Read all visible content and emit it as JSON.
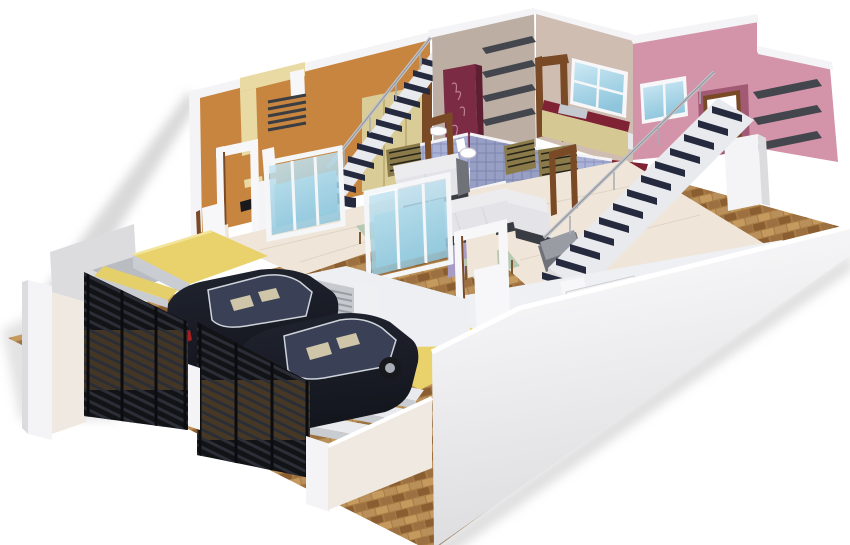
{
  "image": {
    "kind": "3d-architectural-cutaway-render",
    "subject": "duplex-house-floor-plan",
    "visible_text": "none"
  },
  "colors": {
    "bg": "#ffffff",
    "shadow": "#c2c2c2",
    "brick_base": "#a87a44",
    "brick_dark": "#8a5e31",
    "brick_mid": "#9c7040",
    "brick_light": "#c59a5e",
    "brick_soft": "#b9905a",
    "wall_white": "#f4f4f6",
    "wall_white_shade": "#dcdcdf",
    "wall_cream": "#efe9e1",
    "orange_wall": "#c8853f",
    "cream_arch": "#e9d9a3",
    "beige_wall": "#cfbdb1",
    "partition_wall": "#bdaea4",
    "pink_wall": "#d394a9",
    "pink_wall_dark": "#a25a74",
    "maroon_wall": "#8d4862",
    "lavender_wall": "#a89bc4",
    "tile_blue": "#a9b1d6",
    "tile_line": "#8f97c2",
    "glass_blue_light": "#cde9f4",
    "glass_blue_deep": "#8fc6dd",
    "glass_teal": "#9fd2da",
    "frame_white": "#f7f7f9",
    "door_brown": "#7a4a26",
    "wardrobe_cream": "#d9cc96",
    "cabinet_maroon": "#7c2b45",
    "shelf_dark": "#43464c",
    "stair_tread": "#262a3e",
    "stair_stringer": "#e8eaee",
    "handrail_silver": "#c0c3c9",
    "sofa_white": "#ececef",
    "sofa_dark": "#3a3c44",
    "sofa_gray": "#70727a",
    "table_green": "#b7c8b2",
    "counter_maroon": "#7e2234",
    "cabinet_kitchen": "#d6c893",
    "steel": "#c4c9cf",
    "stove_black": "#1d1f24",
    "yellow_porch": "#e9d26b",
    "yellow_step": "#e5cf6a",
    "concrete": "#c9ccd1",
    "gate_black": "#121317",
    "gate_slat": "#2b2e36",
    "gate_tan": "#96713a",
    "car_body": "#20242f",
    "car_body_dark": "#14161e",
    "car_glass": "#3a4156",
    "car_trim": "#cfd3da",
    "car_seat": "#cfc5a8",
    "wheel_dark": "#17181c",
    "wheel_silver": "#a9adb5",
    "taillight_red": "#a81f1f",
    "floor_marble": "#efe6d9",
    "louver_brown": "#8a7a4a",
    "seam_gray": "#d9d9de"
  },
  "scene": {
    "objects": [
      "brick-paved-yard",
      "white-compound-wall",
      "black-slatted-gate-left",
      "black-slatted-gate-right",
      "sedan-car-rear",
      "sedan-car-front",
      "yellow-porch-left-unit",
      "yellow-porch-right-unit",
      "orange-feature-wall",
      "cream-arch-decor",
      "staircase-left-unit",
      "staircase-right-unit",
      "pink-feature-wall",
      "wall-shelves",
      "kitchen-granite-counters",
      "blue-tiled-bathrooms",
      "glass-partitions",
      "l-shaped-sofas",
      "coffee-tables",
      "maroon-wardrobe-cabinet",
      "cream-wardrobe",
      "wash-basin",
      "door-frames"
    ]
  }
}
